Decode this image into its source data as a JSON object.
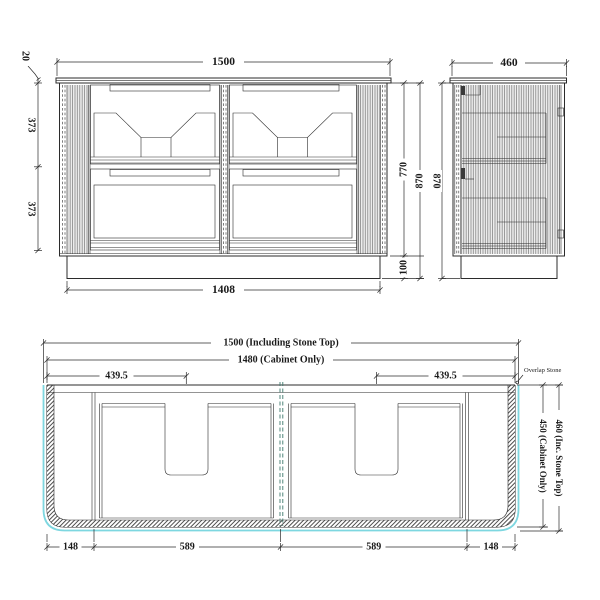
{
  "drawing": {
    "front_view": {
      "dim_stone_thickness": "20",
      "dim_overall_width": "1500",
      "dim_upper_drawer_height": "373",
      "dim_lower_drawer_height": "373",
      "dim_cabinet_height": "770",
      "dim_total_height": "870",
      "dim_kick_height": "100",
      "dim_kick_width": "1408"
    },
    "side_view": {
      "dim_depth": "460",
      "dim_height": "870"
    },
    "plan_view": {
      "dim_overall_width": "1500 (Including Stone Top)",
      "dim_cabinet_width": "1480 (Cabinet Only)",
      "dim_basin_center_left": "439.5",
      "dim_basin_center_right": "439.5",
      "label_overlap_stone": "Overlap Stone",
      "dim_depth_stone": "460 (Inc. Stone Top)",
      "dim_depth_cabinet": "450 (Cabinet Only)",
      "dim_end_left": "148",
      "dim_bay_left": "589",
      "dim_bay_right": "589",
      "dim_end_right": "148"
    },
    "colors": {
      "stone_outline_cyan": "#7ed7e0",
      "divider_teal": "#3f7a6e",
      "line_black": "#2b2b2b"
    }
  }
}
